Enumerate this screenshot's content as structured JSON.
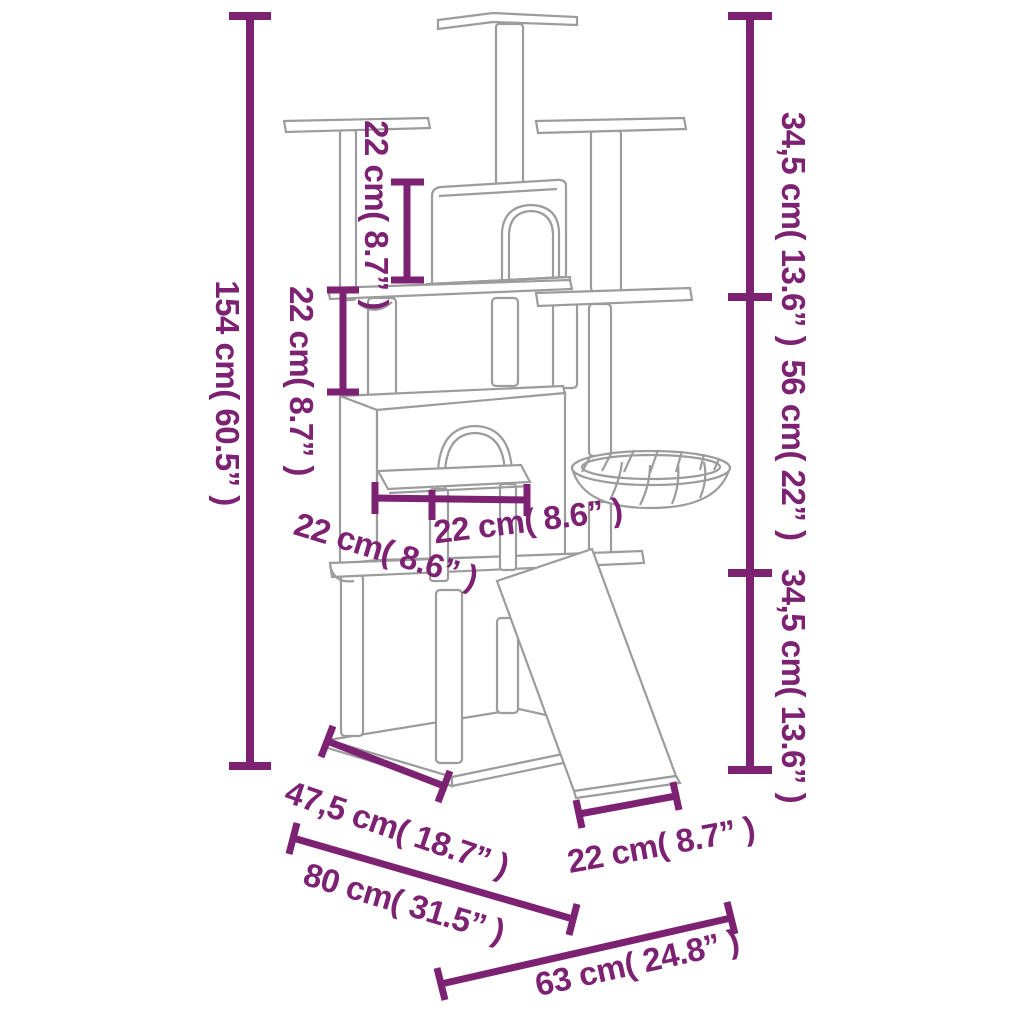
{
  "diagram": {
    "accent_color": "#7d2272",
    "outline_color": "#9c9c9c"
  },
  "dims": [
    {
      "id": "total-height",
      "text": "154 cm( 60.5” )",
      "cm": 154,
      "inch": 60.5
    },
    {
      "id": "top-house-height",
      "text": "22 cm( 8.7” )",
      "cm": 22,
      "inch": 8.7
    },
    {
      "id": "shelf-gap-height",
      "text": "22 cm( 8.7” )",
      "cm": 22,
      "inch": 8.7
    },
    {
      "id": "upper-section-height",
      "text": "34,5 cm( 13.6” )",
      "cm": 34.5,
      "inch": 13.6
    },
    {
      "id": "middle-section-height",
      "text": "56 cm( 22” )",
      "cm": 56,
      "inch": 22
    },
    {
      "id": "lower-section-height",
      "text": "34,5 cm( 13.6” )",
      "cm": 34.5,
      "inch": 13.6
    },
    {
      "id": "table-width",
      "text": "22 cm( 8.6” )",
      "cm": 22,
      "inch": 8.6
    },
    {
      "id": "table-depth",
      "text": "22 cm( 8.6” )",
      "cm": 22,
      "inch": 8.6
    },
    {
      "id": "base-side-depth",
      "text": "47,5 cm( 18.7” )",
      "cm": 47.5,
      "inch": 18.7
    },
    {
      "id": "overall-width",
      "text": "80 cm( 31.5” )",
      "cm": 80,
      "inch": 31.5
    },
    {
      "id": "ramp-width",
      "text": "22 cm( 8.7” )",
      "cm": 22,
      "inch": 8.7
    },
    {
      "id": "overall-depth",
      "text": "63 cm( 24.8” )",
      "cm": 63,
      "inch": 24.8
    }
  ]
}
